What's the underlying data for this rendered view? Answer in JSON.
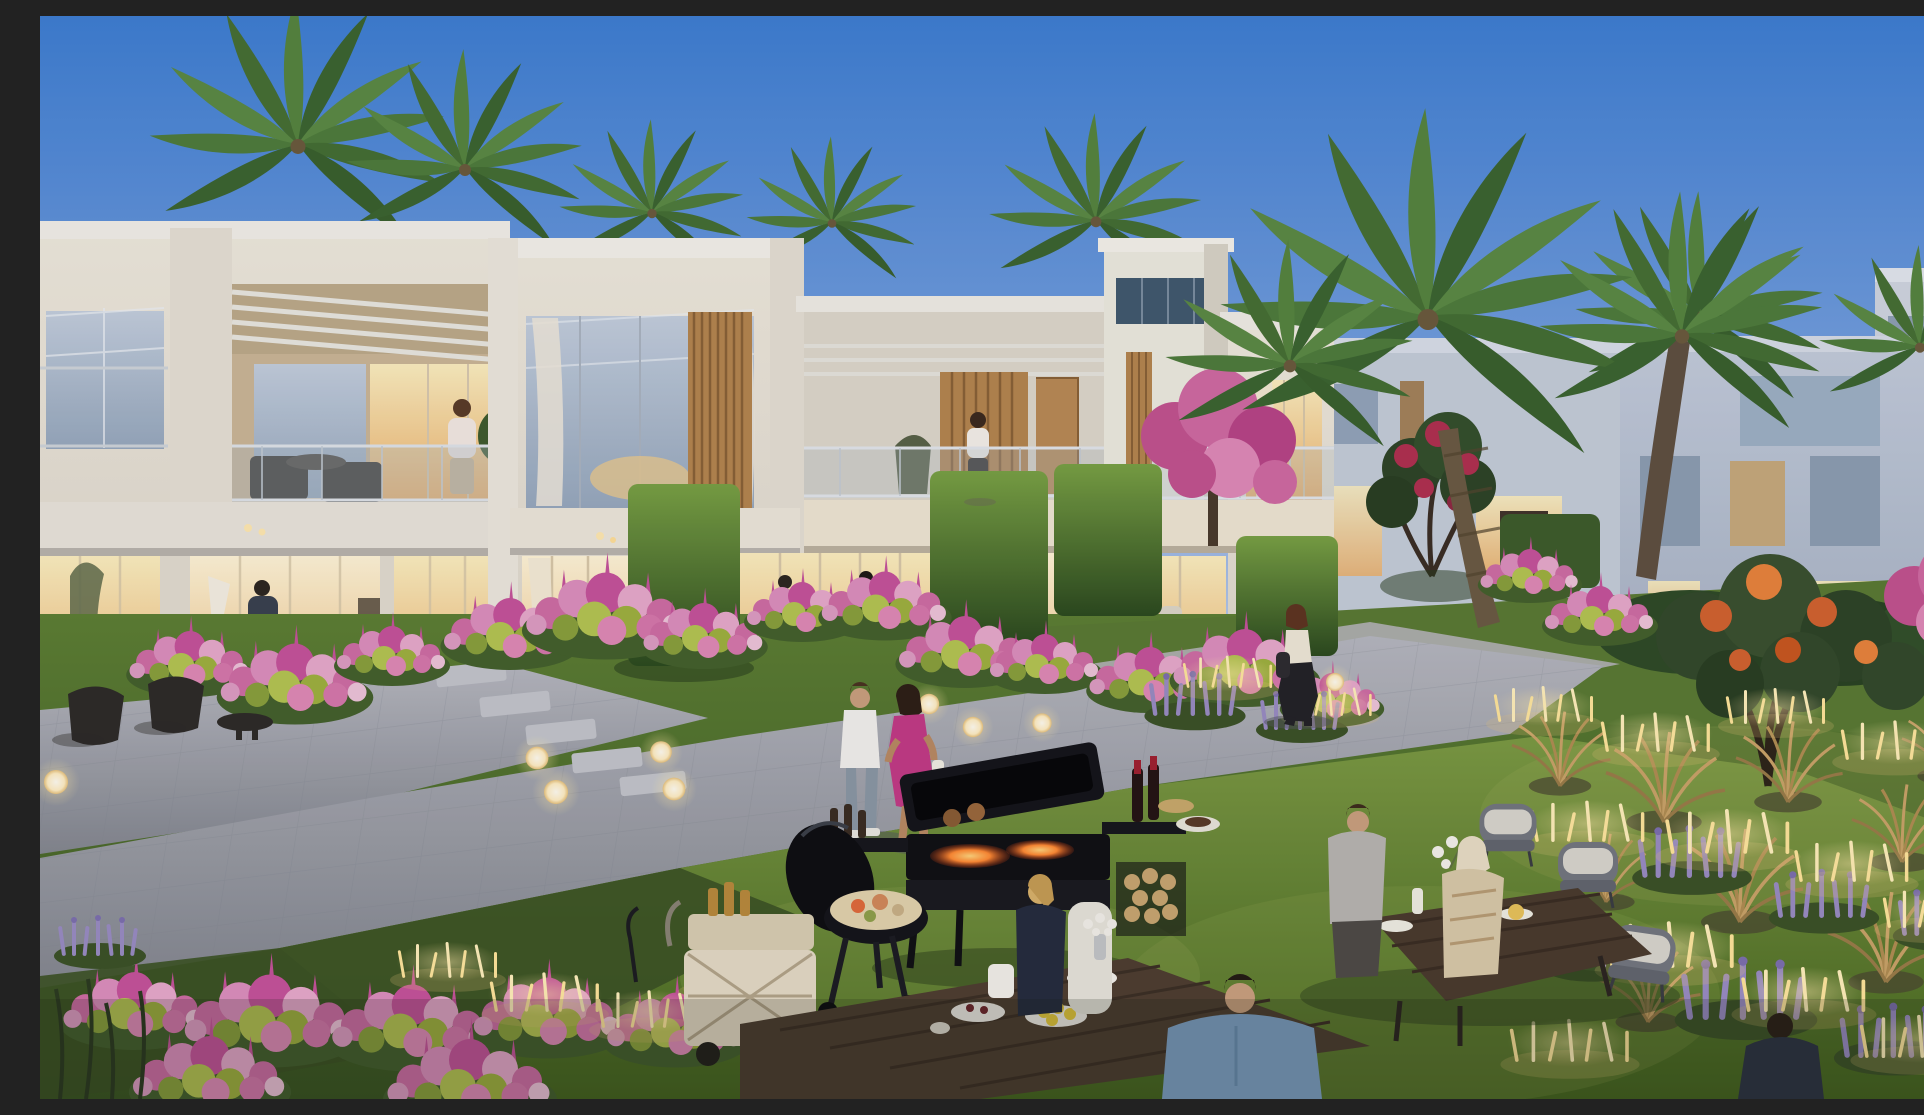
{
  "meta": {
    "title": "Twilight courtyard rendering of a modern townhouse community",
    "description": "Photorealistic dusk rendering: a row of white two-storey modern townhouses with wood-slat accents, glass balconies and warmly lit interiors; palm trees, sheared hedges, pink flower beds, lavender and golden grasses with glowing stick lights; residents stroll a paver walkway, a barbecue station smokes on the lawn and groups dine at outdoor tables.",
    "type": "architectural-render",
    "time_of_day": "dusk"
  },
  "palette": {
    "sky_top": "#3e7ed2",
    "sky_mid": "#7aa2e0",
    "sky_horizon": "#cdd8ee",
    "wall_light": "#efe9dd",
    "wall_shade": "#d7d2c9",
    "wall_far_blue": "#b7c1d3",
    "window_warm": "#f6c987",
    "window_dusk": "#b9c6d8",
    "wood_slat": "#b5854f",
    "palm_green": "#4e7c3b",
    "hedge_green": "#4e7a33",
    "grass_lit": "#6d8c3c",
    "grass_dark": "#3f5d26",
    "path_gray": "#a9acb5",
    "flower_pink": "#d06ca6",
    "flower_magenta": "#c24f95",
    "chartreuse": "#aebc4d",
    "lavender": "#998cc2",
    "gold_grass": "#caa368",
    "stick_light": "#ffe59a",
    "fire_orange": "#ff8a33",
    "dress_magenta": "#c23a85",
    "shirt_blue": "#7fa3c6"
  },
  "scene": {
    "sky": {
      "label": "clear dusk sky gradient"
    },
    "buildings": [
      {
        "label": "left townhouse with pergola balcony and lit lounge"
      },
      {
        "label": "center townhouse with double-height glazing and wood slats"
      },
      {
        "label": "recessed balcony unit with timber feature wall"
      },
      {
        "label": "white roof tower with dark clerestory ribbon window"
      },
      {
        "label": "right townhouse with glass balcony and slat column"
      },
      {
        "label": "distant bluish villas at far right"
      }
    ],
    "vegetation": [
      {
        "label": "palm trees behind rooflines"
      },
      {
        "label": "large leaning palm on the right"
      },
      {
        "label": "sheared box hedges"
      },
      {
        "label": "pink and chartreuse flower beds"
      },
      {
        "label": "crimson bougainvillea tree"
      },
      {
        "label": "flame tree with orange blossom"
      },
      {
        "label": "lavender and golden ornamental grasses"
      }
    ],
    "people": [
      {
        "label": "man on left balcony holding phone"
      },
      {
        "label": "woman standing on center balcony"
      },
      {
        "label": "residents seated in lit interiors"
      },
      {
        "label": "couple strolling the walkway, woman in magenta dress"
      },
      {
        "label": "woman in black trousers walking the right path"
      },
      {
        "label": "blonde woman in navy at garden table"
      },
      {
        "label": "man in blue shirt seen from behind"
      },
      {
        "label": "couple dining at right table"
      }
    ],
    "objects": [
      {
        "label": "barbecue station with open lid and glowing coals"
      },
      {
        "label": "kettle grill with food platter"
      },
      {
        "label": "cream folding serving cart"
      },
      {
        "label": "dark timber dining tables with plates, lemons and flowers"
      },
      {
        "label": "rattan dining chairs"
      },
      {
        "label": "glowing sphere path lamps"
      },
      {
        "label": "clusters of glowing stick lights"
      }
    ]
  }
}
